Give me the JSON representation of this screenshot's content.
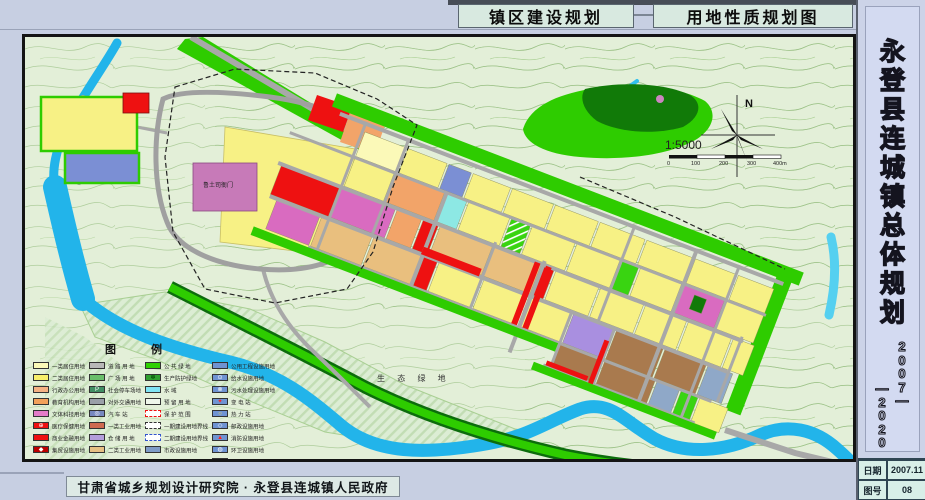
{
  "titles": {
    "left": "镇区建设规划",
    "right": "用地性质规划图"
  },
  "sidebar": {
    "title_chars": [
      "永",
      "登",
      "县",
      "连",
      "城",
      "镇",
      "总",
      "体",
      "规",
      "划"
    ],
    "years_col1": [
      "2",
      "0",
      "0",
      "7",
      "—"
    ],
    "years_col2": [
      "—",
      "2",
      "0",
      "2",
      "0"
    ],
    "date_label": "日期",
    "date_value": "2007.11",
    "sheet_label": "图号",
    "sheet_value": "08"
  },
  "footer": {
    "credit": "甘肃省城乡规划设计研究院 · 永登县连城镇人民政府"
  },
  "map": {
    "labels": {
      "eco_green": "生 态 绿 地",
      "heritage": "鲁土司衙门"
    },
    "compass": {
      "north": "N",
      "scale": "1:5000",
      "bar_ticks": [
        "0",
        "100",
        "200",
        "300",
        "400m"
      ]
    },
    "colors": {
      "residential": "#f7f185",
      "commercial": "#ee1111",
      "culture": "#d96bc0",
      "education": "#f2a469",
      "industry": "#e9bf7e",
      "warehouse": "#a98fe0",
      "utility": "#8fa8c8",
      "green": "#2ecc00",
      "water": "#22b4ea",
      "road": "#a8a8a8"
    }
  },
  "legend": {
    "title": "图  例",
    "columns": [
      {
        "items": [
          {
            "label": "一类居住用地",
            "color": "#fbf9b8"
          },
          {
            "label": "二类居住用地",
            "color": "#f8ef6a"
          },
          {
            "label": "行政办公用地",
            "color": "#f4b183"
          },
          {
            "label": "教育机构用地",
            "color": "#f2a05a"
          },
          {
            "label": "文体科技用地",
            "color": "#e47cc8"
          },
          {
            "label": "医疗保健用地",
            "color": "#ee1111",
            "sym": "⊕",
            "symColor": "#ffffff"
          },
          {
            "label": "商业金融用地",
            "color": "#ee1111"
          },
          {
            "label": "集贸设施用地",
            "color": "#bb0000",
            "sym": "◆",
            "symColor": "#ffffff"
          }
        ]
      },
      {
        "items": [
          {
            "label": "道 路 用 地",
            "color": "#b8b8b8"
          },
          {
            "label": "广 场 用 地",
            "color": "#6abf6a"
          },
          {
            "label": "社会停车场地",
            "color": "#418e63",
            "sym": "P",
            "symColor": "#ffffff"
          },
          {
            "label": "对外交通用地",
            "color": "#9aa0a8"
          },
          {
            "label": "汽 车 站",
            "color": "#7788c0",
            "sym": "◎",
            "symColor": "#ffffff"
          },
          {
            "label": "一类工业用地",
            "color": "#cf6a50"
          },
          {
            "label": "仓 储 用 地",
            "color": "#b39ddb"
          },
          {
            "label": "二类工业用地",
            "color": "#e6c083"
          }
        ]
      },
      {
        "items": [
          {
            "label": "公 共 绿 地",
            "color": "#2ed000"
          },
          {
            "label": "生产防护绿地",
            "color": "#2f9f2f",
            "sym": "✽",
            "symColor": "#0a5a0a"
          },
          {
            "label": "水 域",
            "color": "#7fe4f4"
          },
          {
            "label": "预 留 用 地",
            "color": "#eef6ea"
          },
          {
            "label": "保 护 范 围",
            "color": "#ffffff",
            "dash": "#ee1111"
          },
          {
            "label": "一期建设用地界线",
            "color": "#ffffff",
            "dash": "#333333"
          },
          {
            "label": "二期建设用地界线",
            "color": "#ffffff",
            "dash": "#3355cc"
          },
          {
            "label": "市政设施用地",
            "color": "#7f9cc8"
          }
        ]
      },
      {
        "items": [
          {
            "label": "公用工程设施用地",
            "color": "#6f93d2"
          },
          {
            "label": "给水设施用地",
            "color": "#6f93d2",
            "sym": "⊙",
            "symColor": "#ffffff"
          },
          {
            "label": "污水处理设施用地",
            "color": "#6f93d2",
            "sym": "⊗",
            "symColor": "#ffffff"
          },
          {
            "label": "变 电 站",
            "color": "#6f93d2",
            "sym": "✦",
            "symColor": "#ff2222"
          },
          {
            "label": "热 力 站",
            "color": "#6f93d2",
            "sym": "○",
            "symColor": "#ffe24a"
          },
          {
            "label": "邮政设施用地",
            "color": "#6f93d2",
            "sym": "◇",
            "symColor": "#ffffff"
          },
          {
            "label": "消防设施用地",
            "color": "#6f93d2",
            "sym": "▲",
            "symColor": "#ff2222"
          },
          {
            "label": "环卫设施用地",
            "color": "#6f93d2",
            "sym": "◍",
            "symColor": "#ffffff"
          },
          {
            "label": "行政管理范围界线",
            "color": "#c4c9cf"
          }
        ]
      }
    ]
  }
}
